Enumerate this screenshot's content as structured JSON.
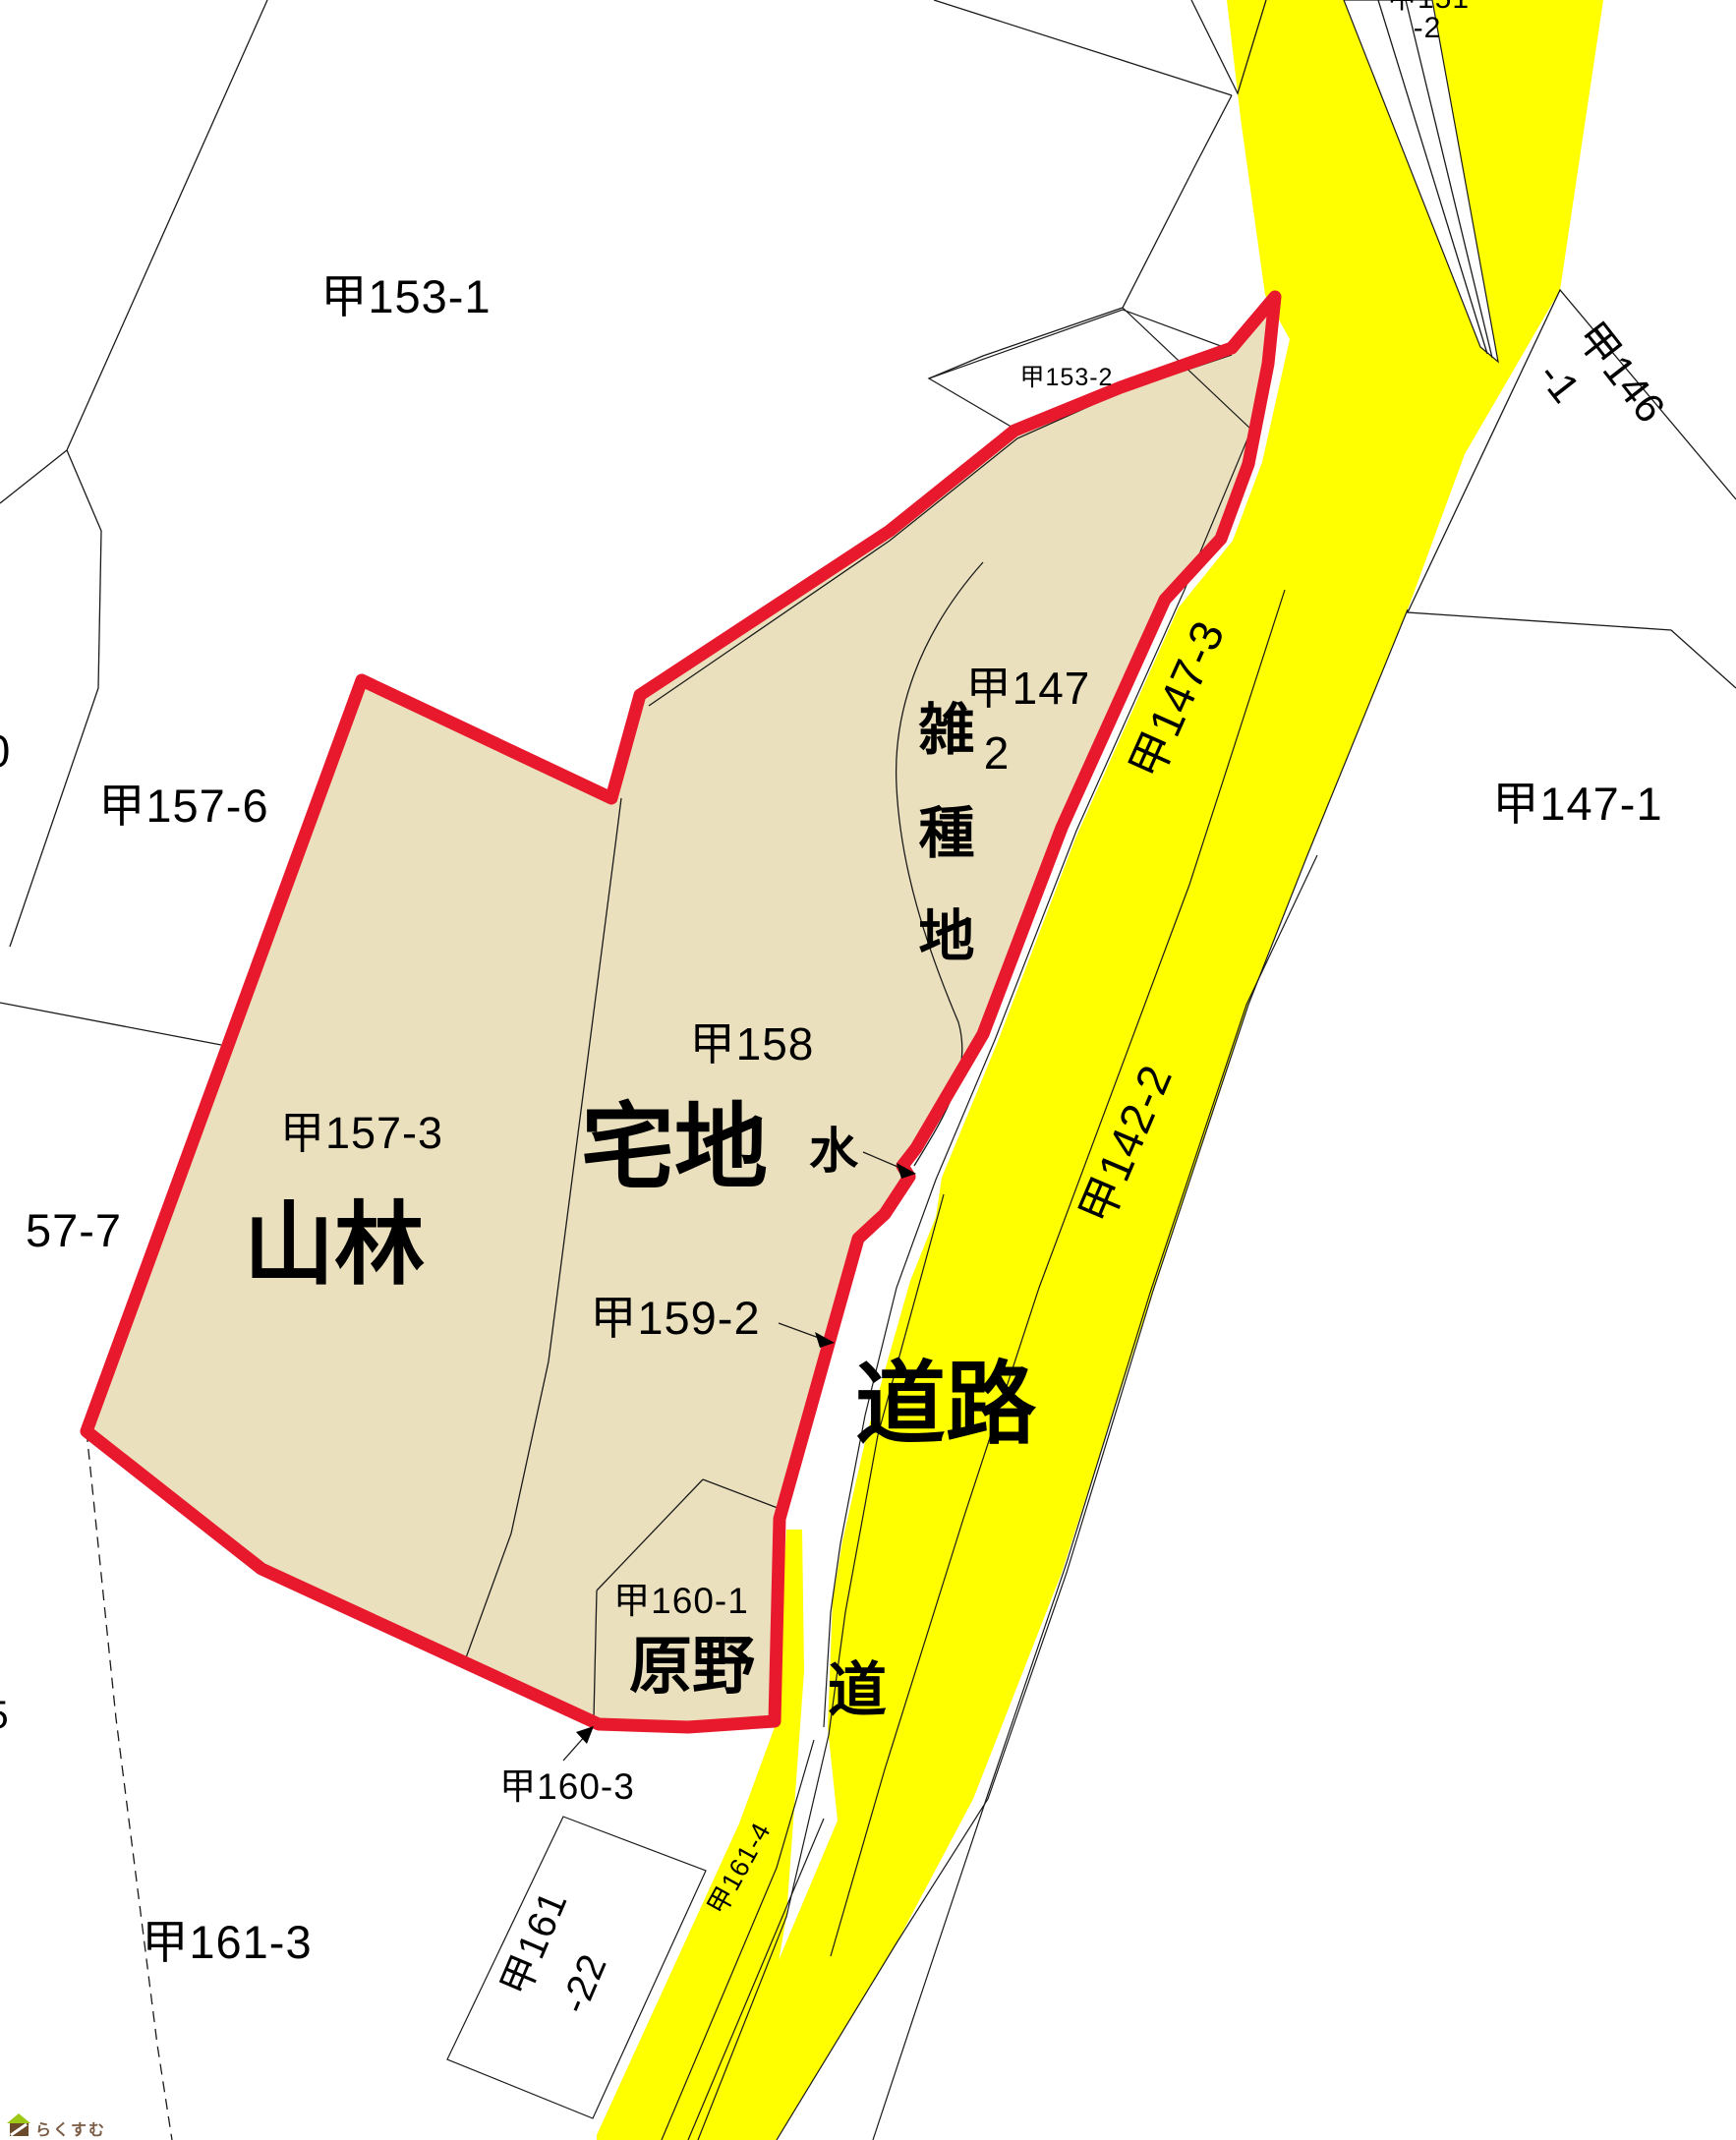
{
  "labels": {
    "p153_1": "甲153-1",
    "p153_2": "甲153-2",
    "p151_partial": "甲151",
    "p151_suffix": "-2",
    "p146": "甲146",
    "p146_suffix": "-1",
    "p147_1": "甲147-1",
    "p147_3": "甲147-3",
    "p142_2": "甲142-2",
    "p157_6": "甲157-6",
    "p157_7_partial": "57-7",
    "p157_3": "甲157-3",
    "p158": "甲158",
    "p147": "甲147",
    "p147_2_suffix": "2",
    "p159_2": "甲159-2",
    "p160_1": "甲160-1",
    "p160_3": "甲160-3",
    "p161_3": "甲161-3",
    "p161_main": "甲161",
    "p161_22_suffix": "-22",
    "p161_4": "甲161-4",
    "edge_partial_top": "0",
    "edge_partial_bottom": "5",
    "misc": [
      "雑",
      "種",
      "地"
    ],
    "forest": "山林",
    "residential": "宅地",
    "wasteland": "原野",
    "road_big": "道路",
    "road_small": "道",
    "water": "水"
  },
  "colors": {
    "road_fill": "#ffff00",
    "subject_fill": "#ebe0bd",
    "highlight_red": "#e8192d",
    "line_black": "#1a1a1a",
    "logo_brown": "#6b4a2b",
    "logo_green": "#9dc815"
  },
  "logo": {
    "text": "らくすむ"
  }
}
